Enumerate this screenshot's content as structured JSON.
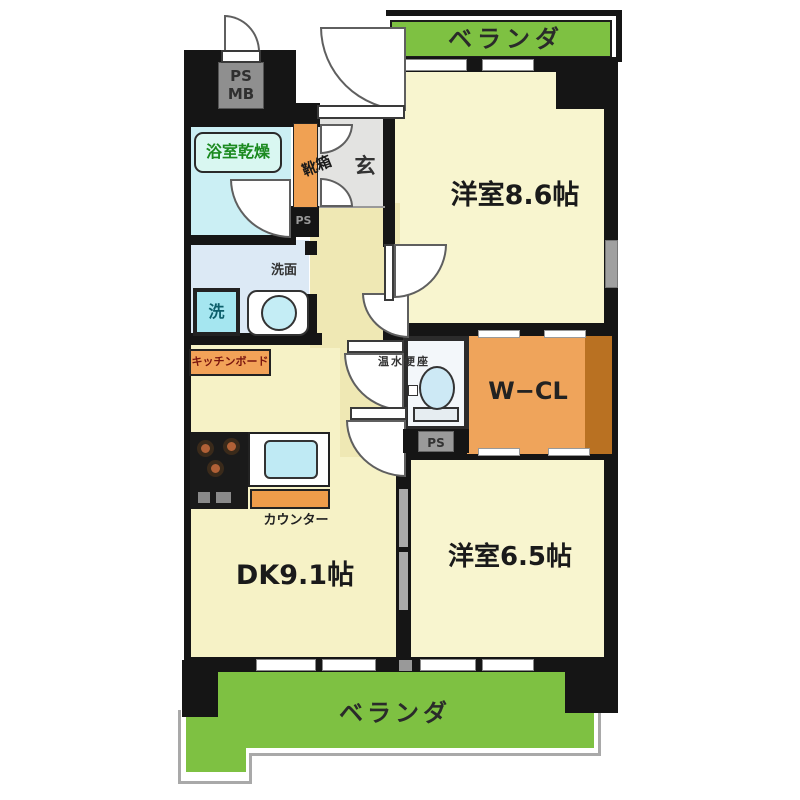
{
  "plan": {
    "verandas": {
      "top": "ベランダ",
      "bottom": "ベランダ"
    },
    "rooms": {
      "western_86": "洋室8.6帖",
      "western_65": "洋室6.5帖",
      "dk": "DK9.1帖",
      "walk_in_closet": "W−CL",
      "entrance": "玄",
      "shoe_box": "靴箱",
      "bathroom_dryer": "浴室乾燥",
      "washroom": "洗面",
      "washer": "洗",
      "toilet": "温水便座"
    },
    "fixtures": {
      "counter": "カウンター",
      "kitchen_board": "キッチンボード",
      "ps_mb_line1": "PS",
      "ps_mb_line2": "MB",
      "ps_entry": "PS",
      "ps_shaft": "PS"
    },
    "colors": {
      "wall": "#151515",
      "room": "#F8F5CF",
      "hall": "#EFE8B4",
      "veranda_green": "#7EC142",
      "orange": "#EFA45B",
      "orange_dark": "#B97122",
      "bathroom": "#CBEFF4",
      "washroom": "#DCE9F5",
      "entrance_floor": "#E3E3E1",
      "water": "#BFEAF4"
    }
  }
}
